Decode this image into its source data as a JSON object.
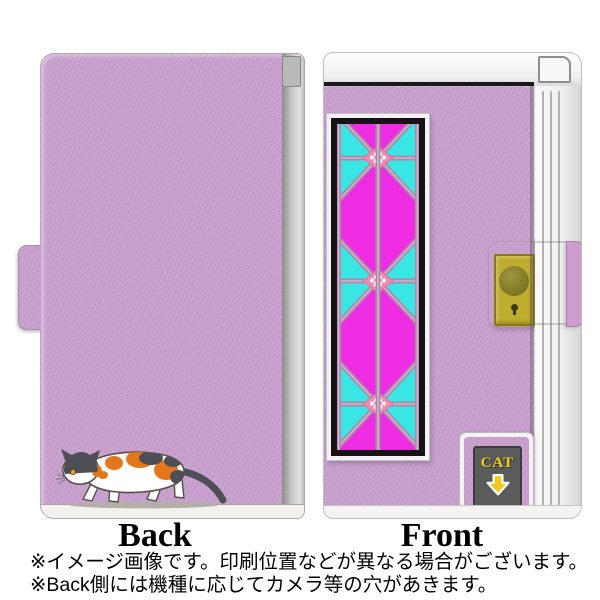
{
  "product": {
    "type": "flip-phone-case-product-image",
    "motifs": {
      "back_cover": "calico-cat-walking-illustration",
      "front_panel": "stained-glass-asanoha-lattice-with-paw-prints",
      "front_panel_paw_rows": 3
    }
  },
  "views": {
    "back": {
      "label": "Back"
    },
    "front": {
      "label": "Front"
    }
  },
  "cat_window": {
    "label": "CAT",
    "icon": "down-arrow"
  },
  "notes": [
    "※イメージ画像です。印刷位置などが異なる場合がございます。",
    "※Back側には機種に応じてカメラ等の穴があきます。"
  ],
  "colors": {
    "case_lavender": "#c8a0cd",
    "spine_silver": "#f4f3f4",
    "stained_magenta": "#ee2de2",
    "stained_cyan": "#3ae6e3",
    "lattice_mauve": "#a98ba9",
    "lattice_light": "#d2b2cc",
    "paw_pink": "#f08bb0",
    "clasp_plate_yellow": "#bead2e",
    "strap_pink": "#cf9cd0",
    "window_gray": "#5c5b5c",
    "cat_label_yellow": "#f2d313",
    "arrow_yellow": "#f6c71b",
    "cat_orange": "#e2771d",
    "cat_dark": "#4e4e56",
    "text_black": "#111111"
  }
}
